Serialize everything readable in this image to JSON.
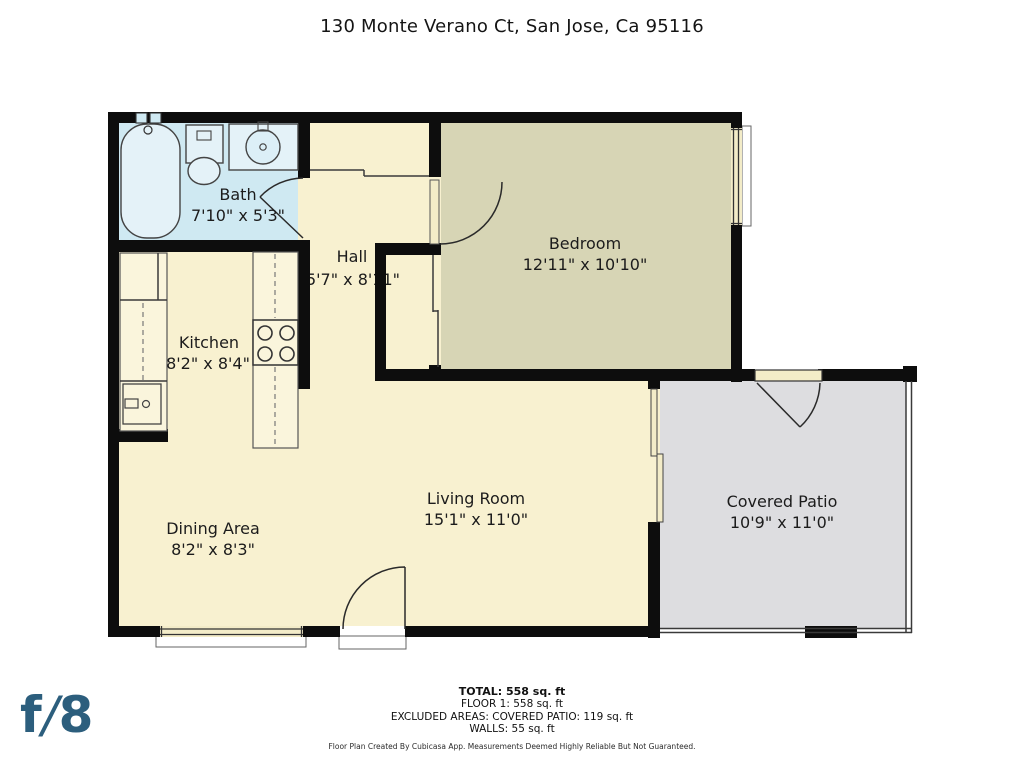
{
  "title": "130 Monte Verano Ct, San Jose, Ca 95116",
  "rooms": {
    "bath": {
      "name": "Bath",
      "dims": "7'10\" x 5'3\""
    },
    "hall": {
      "name": "Hall",
      "dims": "5'7\" x 8'11\""
    },
    "bedroom": {
      "name": "Bedroom",
      "dims": "12'11\" x 10'10\""
    },
    "kitchen": {
      "name": "Kitchen",
      "dims": "8'2\" x 8'4\""
    },
    "dining": {
      "name": "Dining Area",
      "dims": "8'2\" x 8'3\""
    },
    "living": {
      "name": "Living Room",
      "dims": "15'1\" x 11'0\""
    },
    "patio": {
      "name": "Covered Patio",
      "dims": "10'9\" x 11'0\""
    }
  },
  "summary": {
    "total": "TOTAL: 558 sq. ft",
    "floor1": "FLOOR 1: 558 sq. ft",
    "excluded": "EXCLUDED AREAS: COVERED PATIO: 119 sq. ft",
    "walls": "WALLS: 55 sq. ft"
  },
  "disclaimer": "Floor Plan Created By Cubicasa App. Measurements Deemed Highly Reliable But Not Guaranteed.",
  "logo": {
    "f": "f",
    "slash": "/",
    "eight": "8"
  },
  "colors": {
    "wall": "#0d0d0d",
    "floor_main": "#f8f1d0",
    "floor_bedroom": "#d7d5b5",
    "floor_bath": "#cfe9f2",
    "floor_patio": "#dddde0",
    "logo_blue": "#2c5e7d"
  }
}
